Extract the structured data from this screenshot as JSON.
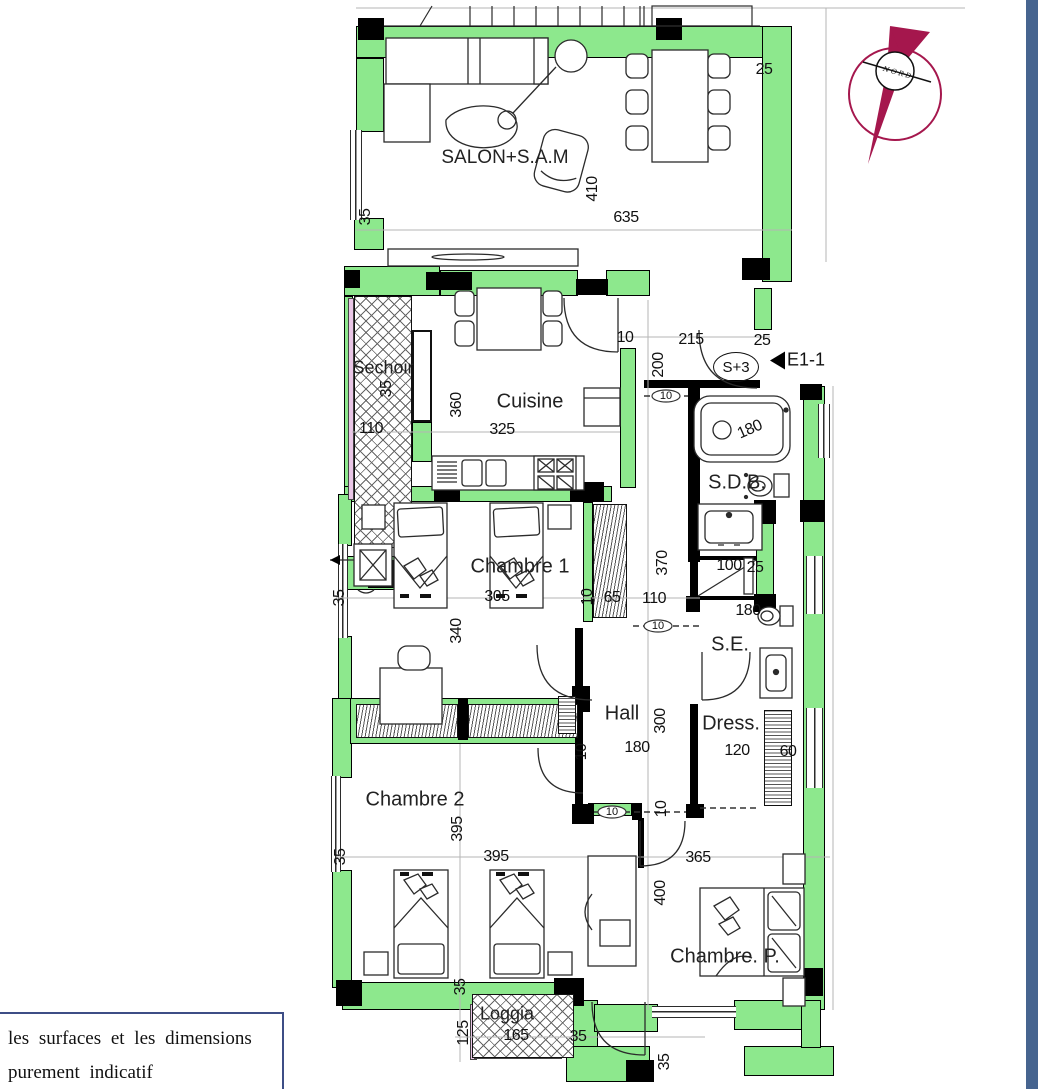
{
  "note": {
    "line1": "les surfaces et les dimensions",
    "line2": "purement indicatif"
  },
  "compass": {
    "label": "NORD"
  },
  "entrance": {
    "unit": "S+3",
    "door": "E1-1"
  },
  "colors": {
    "wall_green": "#8DE88D",
    "compass_red": "#A5174D",
    "frame_blue": "#46648F",
    "rail_pink": "#E9C6E6"
  },
  "rooms": {
    "salon": "SALON+S.A.M",
    "sechoir": "Sechoir",
    "cuisine": "Cuisine",
    "sdb": "S.D.B.",
    "se": "S.E.",
    "hall": "Hall",
    "dress": "Dress.",
    "chambre1": "Chambre 1",
    "chambre2": "Chambre 2",
    "chambre_p": "Chambre. P.",
    "loggia": "Loggia"
  },
  "dims": {
    "d01": "25",
    "d02": "35",
    "d03": "410",
    "d04": "635",
    "d05": "35",
    "d06": "110",
    "d07": "360",
    "d08": "325",
    "d09": "10",
    "d10": "215",
    "d11": "25",
    "d12": "200",
    "d13": "10",
    "d14": "180",
    "d15": "100",
    "d16": "25",
    "d17": "370",
    "d18": "110",
    "d19": "65",
    "d20": "10",
    "d21": "305",
    "d22": "35",
    "d23": "340",
    "d24": "180",
    "d25": "300",
    "d26": "180",
    "d27": "120",
    "d28": "60",
    "d29": "10",
    "d30": "10",
    "d31": "10",
    "d32": "10",
    "d33": "395",
    "d34": "395",
    "d35": "35",
    "d36": "35",
    "d37": "365",
    "d38": "400",
    "d39": "125",
    "d40": "165",
    "d41": "35",
    "d42": "35"
  }
}
